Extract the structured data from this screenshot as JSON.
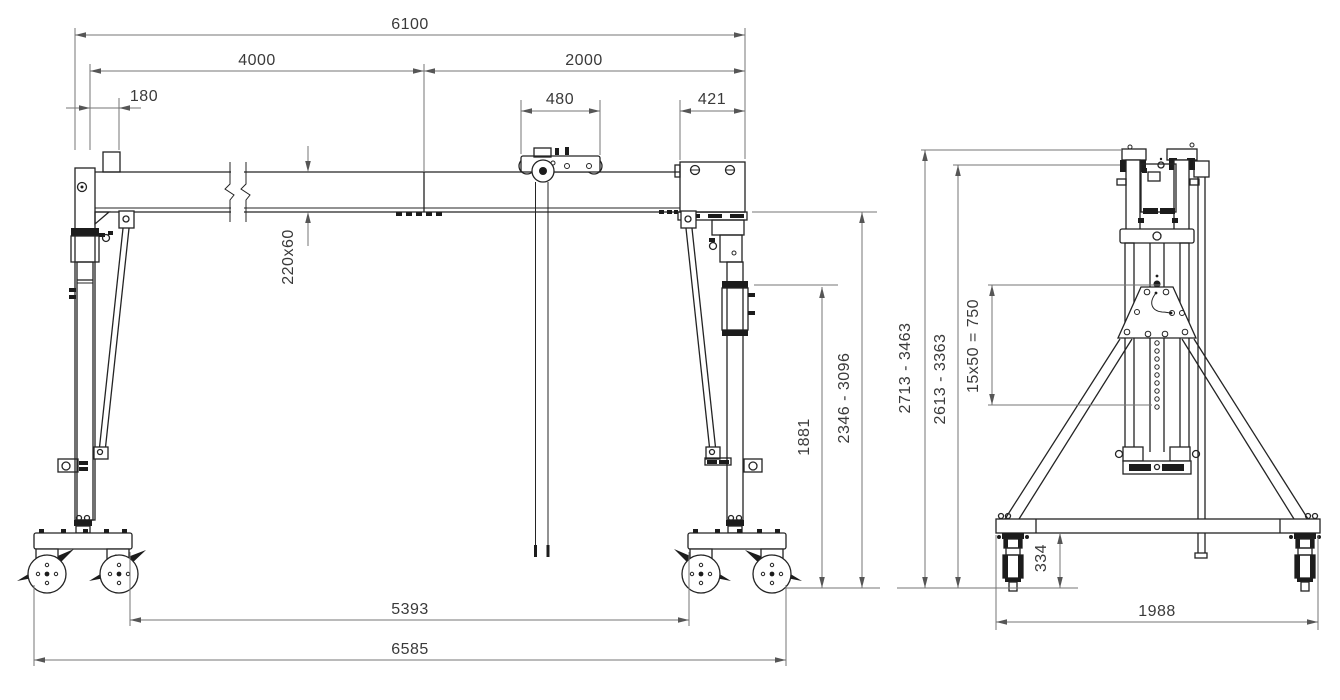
{
  "colors": {
    "background": "#ffffff",
    "structure_line": "#242424",
    "dimension_line": "#767676",
    "dimension_text": "#3a3a3a"
  },
  "front_view": {
    "dims": {
      "overall_span": "6100",
      "main_span": "4000",
      "cantilever_span": "2000",
      "end_offset": "180",
      "trolley_width": "480",
      "support_width": "421",
      "beam_section": "220x60",
      "clearance_height": "1881",
      "underbeam_height_range": "2346 - 3096",
      "inner_wheelbase": "5393",
      "overall_length": "6585"
    }
  },
  "side_view": {
    "dims": {
      "overall_height_range": "2713 - 3463",
      "beam_height_range": "2613 - 3363",
      "height_adjustment": "15x50 = 750",
      "caster_height": "334",
      "base_track_width": "1988"
    }
  }
}
